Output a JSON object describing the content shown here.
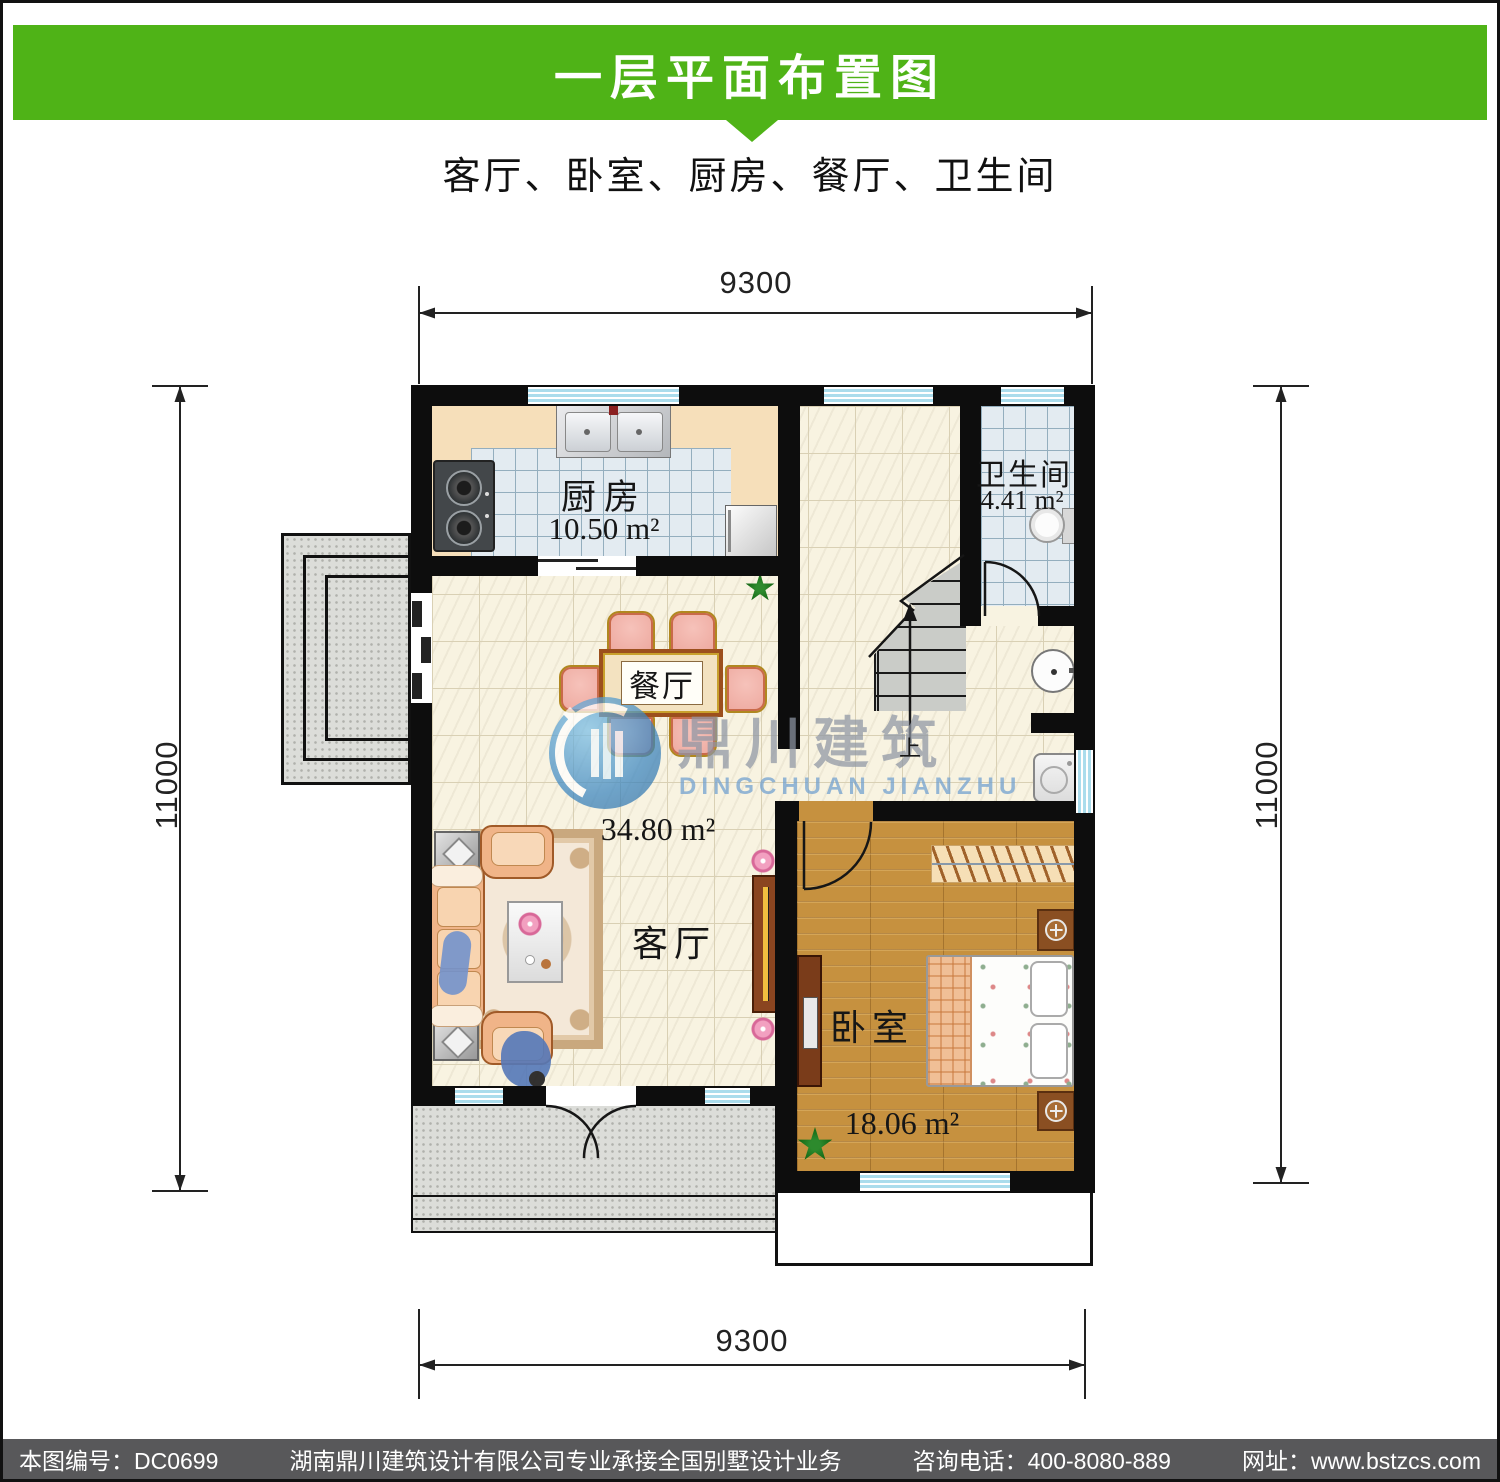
{
  "header": {
    "title": "一层平面布置图",
    "subtitle": "客厅、卧室、厨房、餐厅、卫生间"
  },
  "dims": {
    "top": "9300",
    "bottom": "9300",
    "left": "11000",
    "right": "11000"
  },
  "rooms": {
    "kitchen": {
      "name": "厨房",
      "area": "10.50 m²"
    },
    "bathroom": {
      "name": "卫生间",
      "area": "4.41 m²"
    },
    "dining": {
      "name": "餐厅"
    },
    "living": {
      "name": "客厅",
      "area": "34.80 m²"
    },
    "bedroom": {
      "name": "卧室",
      "area": "18.06 m²"
    },
    "stairs": {
      "up_label": "上"
    }
  },
  "watermark": {
    "cn": "鼎川建筑",
    "en": "DINGCHUAN JIANZHU"
  },
  "footer": {
    "plan_no": "本图编号：DC0699",
    "company": "湖南鼎川建筑设计有限公司专业承接全国别墅设计业务",
    "phone": "咨询电话：400-8080-889",
    "website": "网址：www.bstzcs.com"
  },
  "colors": {
    "accent_green": "#4fb317",
    "footer_bg": "#58585a",
    "wall": "#0d0d0d",
    "floor_tile": "#f8f3e1",
    "wet_tile": "#e3ebf1",
    "wood": "#c6913f",
    "counter": "#f6dfba",
    "watermark_blue": "#3a85c0"
  }
}
